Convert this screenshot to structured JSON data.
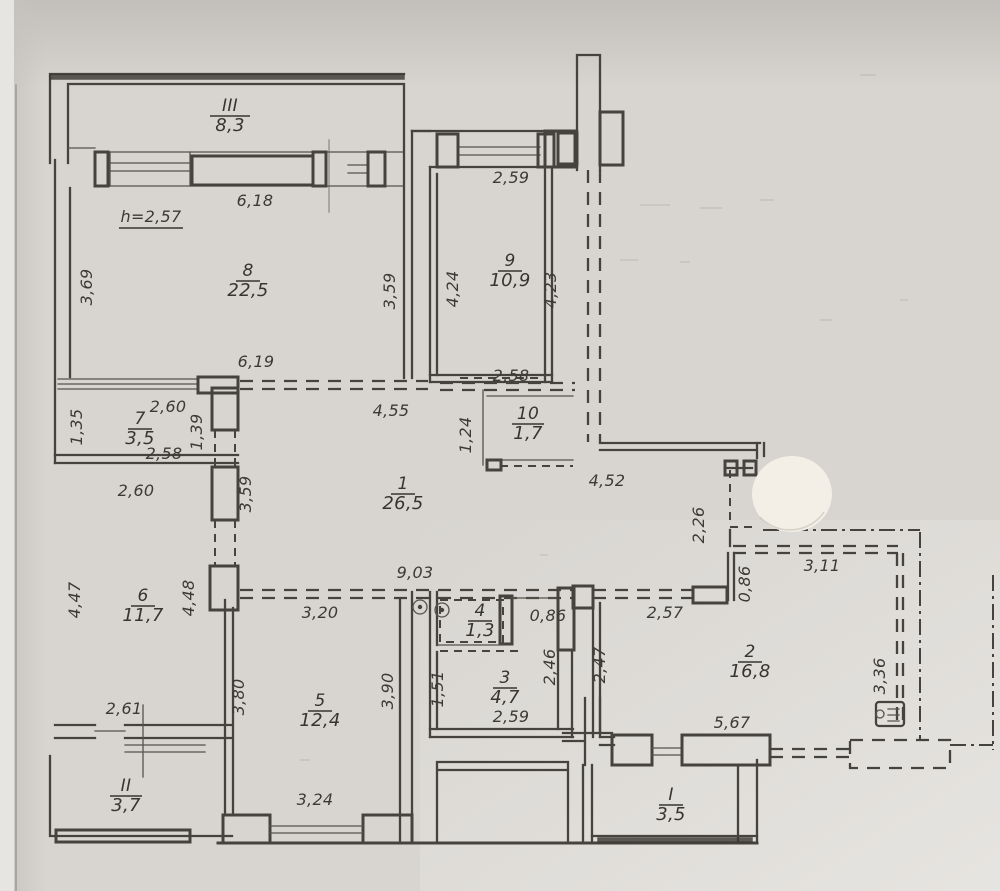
{
  "document": {
    "kind": "scanned apartment floor plan (BTI technical drawing)"
  },
  "colors": {
    "paper": "#d8d5d1",
    "ink": "#46423d",
    "sticker": "#f3efe6"
  },
  "plan": {
    "height_note": {
      "text": "h=2,57",
      "x": 151,
      "y": 222
    },
    "rooms": [
      {
        "number": "III",
        "area": "8,3",
        "x": 230,
        "y": 111
      },
      {
        "number": "8",
        "area": "22,5",
        "x": 248,
        "y": 276
      },
      {
        "number": "9",
        "area": "10,9",
        "x": 510,
        "y": 266
      },
      {
        "number": "7",
        "area": "3,5",
        "x": 140,
        "y": 424
      },
      {
        "number": "10",
        "area": "1,7",
        "x": 528,
        "y": 419
      },
      {
        "number": "1",
        "area": "26,5",
        "x": 403,
        "y": 489
      },
      {
        "number": "6",
        "area": "11,7",
        "x": 143,
        "y": 601
      },
      {
        "number": "4",
        "area": "1,3",
        "x": 480,
        "y": 616
      },
      {
        "number": "3",
        "area": "4,7",
        "x": 505,
        "y": 683
      },
      {
        "number": "5",
        "area": "12,4",
        "x": 320,
        "y": 706
      },
      {
        "number": "2",
        "area": "16,8",
        "x": 750,
        "y": 657
      },
      {
        "number": "II",
        "area": "3,7",
        "x": 126,
        "y": 791
      },
      {
        "number": "I",
        "area": "3,5",
        "x": 671,
        "y": 800
      }
    ],
    "dimensions": [
      {
        "text": "6,18",
        "x": 255,
        "y": 206
      },
      {
        "text": "2,59",
        "x": 511,
        "y": 183
      },
      {
        "text": "6,19",
        "x": 256,
        "y": 367
      },
      {
        "text": "2,60",
        "x": 168,
        "y": 412
      },
      {
        "text": "2,58",
        "x": 164,
        "y": 459
      },
      {
        "text": "2,60",
        "x": 136,
        "y": 496
      },
      {
        "text": "4,55",
        "x": 391,
        "y": 416
      },
      {
        "text": "2,58",
        "x": 511,
        "y": 381
      },
      {
        "text": "4,52",
        "x": 607,
        "y": 486
      },
      {
        "text": "3,11",
        "x": 822,
        "y": 571
      },
      {
        "text": "2,57",
        "x": 665,
        "y": 618
      },
      {
        "text": "9,03",
        "x": 415,
        "y": 578
      },
      {
        "text": "3,20",
        "x": 320,
        "y": 618
      },
      {
        "text": "0,86",
        "x": 548,
        "y": 621
      },
      {
        "text": "2,59",
        "x": 511,
        "y": 722
      },
      {
        "text": "5,67",
        "x": 732,
        "y": 728
      },
      {
        "text": "2,61",
        "x": 124,
        "y": 714
      },
      {
        "text": "3,24",
        "x": 315,
        "y": 805
      },
      {
        "text": "3,69",
        "x": 92,
        "y": 287,
        "rot": -90
      },
      {
        "text": "3,59",
        "x": 395,
        "y": 291,
        "rot": -90
      },
      {
        "text": "4,24",
        "x": 458,
        "y": 289,
        "rot": -90
      },
      {
        "text": "4,23",
        "x": 556,
        "y": 290,
        "rot": -90
      },
      {
        "text": "1,35",
        "x": 82,
        "y": 427,
        "rot": -90
      },
      {
        "text": "1,39",
        "x": 202,
        "y": 432,
        "rot": -90
      },
      {
        "text": "1,24",
        "x": 471,
        "y": 435,
        "rot": -90
      },
      {
        "text": "3,59",
        "x": 251,
        "y": 494,
        "rot": -90
      },
      {
        "text": "2,26",
        "x": 704,
        "y": 525,
        "rot": -90
      },
      {
        "text": "0,86",
        "x": 750,
        "y": 584,
        "rot": -90
      },
      {
        "text": "4,47",
        "x": 80,
        "y": 600,
        "rot": -90
      },
      {
        "text": "4,48",
        "x": 194,
        "y": 598,
        "rot": -90
      },
      {
        "text": "3,80",
        "x": 244,
        "y": 697,
        "rot": -90
      },
      {
        "text": "3,90",
        "x": 393,
        "y": 691,
        "rot": -90
      },
      {
        "text": "1,51",
        "x": 443,
        "y": 689,
        "rot": -90
      },
      {
        "text": "2,46",
        "x": 555,
        "y": 667,
        "rot": -90
      },
      {
        "text": "2,47",
        "x": 605,
        "y": 665,
        "rot": -90
      },
      {
        "text": "3,36",
        "x": 885,
        "y": 676,
        "rot": -90
      }
    ]
  }
}
